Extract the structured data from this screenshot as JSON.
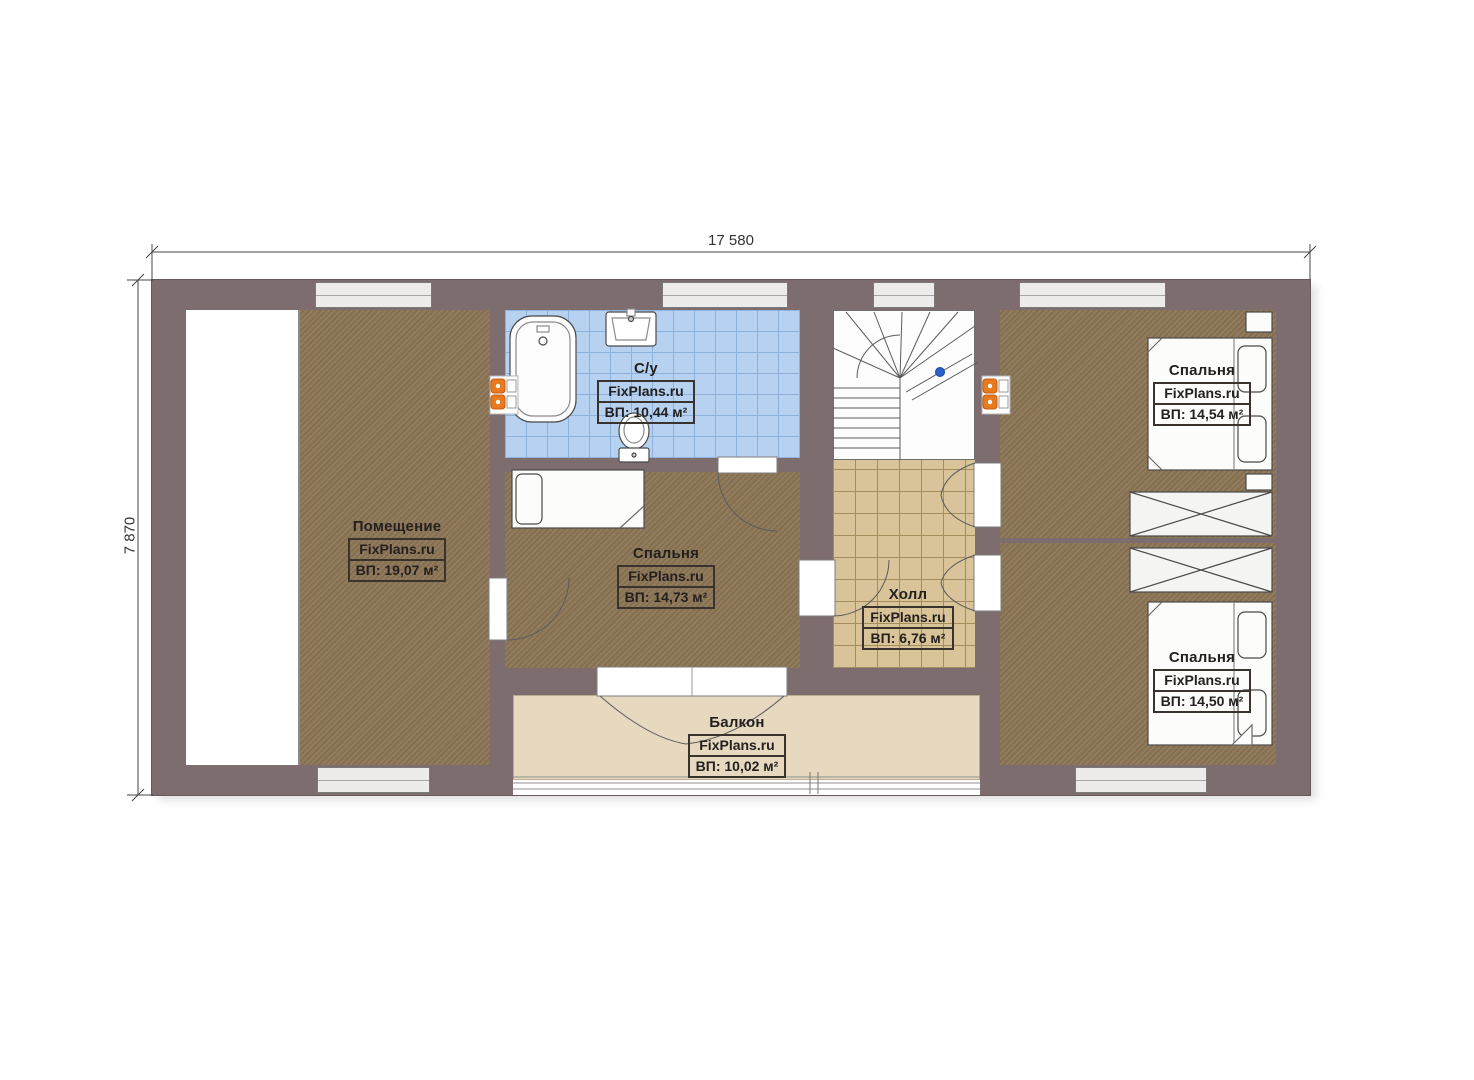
{
  "plan_type": "floor-plan",
  "dimensions": {
    "top": "17 580",
    "left": "7 870"
  },
  "rooms": [
    {
      "key": "utility",
      "name": "Помещение",
      "brand": "FixPlans.ru",
      "area": "ВП: 19,07 м²"
    },
    {
      "key": "bathroom",
      "name": "С/у",
      "brand": "FixPlans.ru",
      "area": "ВП: 10,44 м²"
    },
    {
      "key": "bedroom-middle",
      "name": "Спальня",
      "brand": "FixPlans.ru",
      "area": "ВП: 14,73 м²"
    },
    {
      "key": "hall",
      "name": "Холл",
      "brand": "FixPlans.ru",
      "area": "ВП: 6,76 м²"
    },
    {
      "key": "bedroom-top-right",
      "name": "Спальня",
      "brand": "FixPlans.ru",
      "area": "ВП: 14,54 м²"
    },
    {
      "key": "bedroom-bottom-right",
      "name": "Спальня",
      "brand": "FixPlans.ru",
      "area": "ВП: 14,50 м²"
    },
    {
      "key": "balcony",
      "name": "Балкон",
      "brand": "FixPlans.ru",
      "area": "ВП: 10,02 м²"
    }
  ],
  "colors": {
    "wall": "#7e6d6f",
    "wood_floor": "#8c7555",
    "bathroom_tile": "#b6d2f0",
    "hall_tile": "#d8c498",
    "balcony_floor": "#e6d9c0",
    "window_fill": "#edecea",
    "radiator_orange": "#e8791f",
    "stair_marker_blue": "#2d5fc8"
  }
}
